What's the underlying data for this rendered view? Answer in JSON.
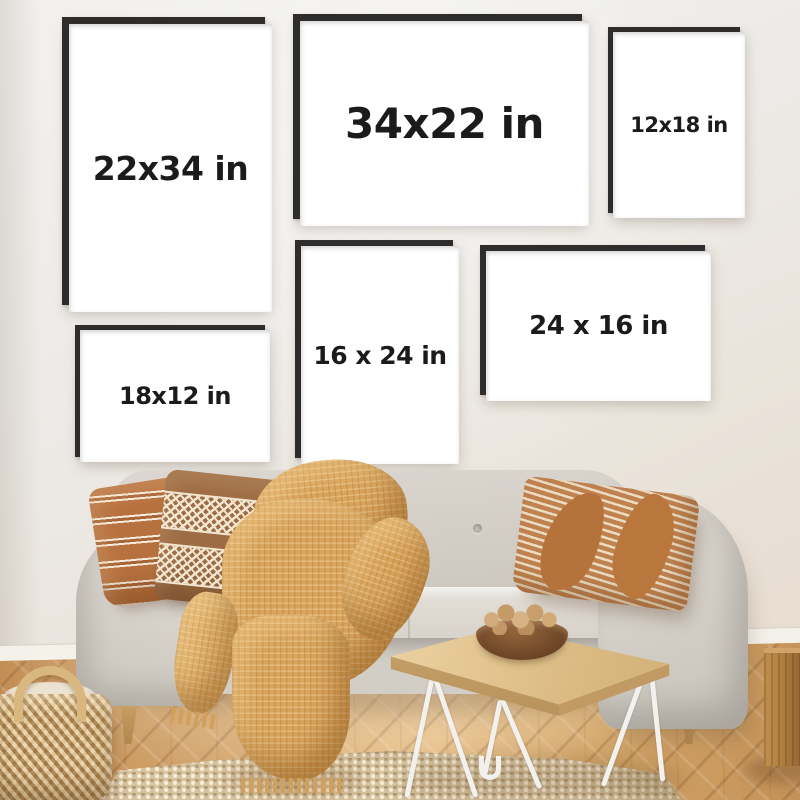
{
  "frames": [
    {
      "label": "22x34 in",
      "orientation": "portrait"
    },
    {
      "label": "34x22 in",
      "orientation": "landscape"
    },
    {
      "label": "12x18 in",
      "orientation": "portrait"
    },
    {
      "label": "18x12 in",
      "orientation": "landscape"
    },
    {
      "label": "16 x 24 in",
      "orientation": "portrait"
    },
    {
      "label": "24 x 16 in",
      "orientation": "landscape"
    }
  ],
  "palette": {
    "wall": "#edeae6",
    "frame_border": "#2f2d2c",
    "frame_mat": "#ffffff",
    "label_text": "#1b1b1b",
    "sofa_fabric": "#d7d3cc",
    "pillow_rust": "#b7713f",
    "pillow_brown": "#9d6c44",
    "pillow_tan": "#c08350",
    "blanket_mustard": "#d9a45c",
    "wood_floor": "#cfa267",
    "table_wood": "#dcbc84",
    "hairpin_legs": "#f3f1ed",
    "rug_jute": "#d7c4a0",
    "basket_wicker": "#c6a067"
  }
}
